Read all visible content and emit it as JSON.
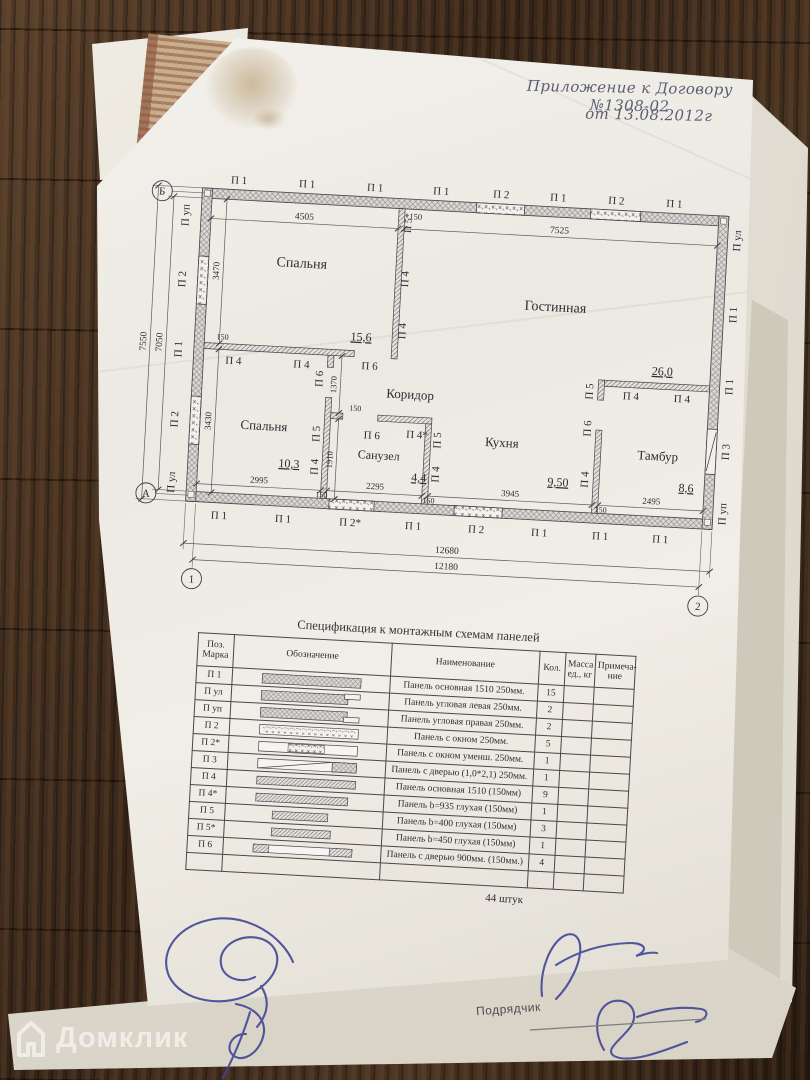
{
  "photo": {
    "handwriting": {
      "line1": "Приложение к Договору №1308-02",
      "line2": "от 13.08.2012г"
    },
    "watermark": {
      "text": "Домклик",
      "icon": "domclick-house-icon"
    },
    "contractor_label": "Подрядчик"
  },
  "colors": {
    "ink_blue": "#3c4396",
    "paper": "#f1eee7",
    "wood": "#432f20",
    "pencil": "#2c2c33"
  },
  "plan": {
    "axes": [
      {
        "label": "Б",
        "x": 22,
        "y": 47
      },
      {
        "label": "А",
        "x": 22,
        "y": 349
      },
      {
        "label": "1",
        "x": 72,
        "y": 432
      },
      {
        "label": "2",
        "x": 578,
        "y": 432
      }
    ],
    "rooms": [
      {
        "name": "Спальня",
        "x": 165,
        "y": 116,
        "fs": 14,
        "area": "15,6",
        "ax": 228,
        "ay": 186
      },
      {
        "name": "Гостинная",
        "x": 420,
        "y": 146,
        "fs": 14,
        "area": "26,0",
        "ax": 530,
        "ay": 204
      },
      {
        "name": "Спальня",
        "x": 136,
        "y": 280,
        "fs": 13,
        "area": "10,3",
        "ax": 163,
        "ay": 316
      },
      {
        "name": "Коридор",
        "x": 280,
        "y": 241,
        "fs": 13
      },
      {
        "name": "Санузел",
        "x": 252,
        "y": 303,
        "fs": 12,
        "area": "4,4",
        "ax": 293,
        "ay": 323
      },
      {
        "name": "Кухня",
        "x": 374,
        "y": 284,
        "fs": 13,
        "area": "9,50",
        "ax": 432,
        "ay": 320
      },
      {
        "name": "Тамбур",
        "x": 530,
        "y": 289,
        "fs": 13,
        "area": "8,6",
        "ax": 560,
        "ay": 319
      }
    ],
    "wall_labels": [
      {
        "t": "П 1",
        "x": 98,
        "y": 36
      },
      {
        "t": "П 1",
        "x": 166,
        "y": 36
      },
      {
        "t": "П 1",
        "x": 234,
        "y": 36
      },
      {
        "t": "П 1",
        "x": 300,
        "y": 36
      },
      {
        "t": "П 2",
        "x": 360,
        "y": 36
      },
      {
        "t": "П 1",
        "x": 417,
        "y": 36
      },
      {
        "t": "П 2",
        "x": 475,
        "y": 36
      },
      {
        "t": "П 1",
        "x": 533,
        "y": 36
      },
      {
        "t": "П уп",
        "x": 50,
        "y": 70,
        "r": -90
      },
      {
        "t": "П 2",
        "x": 50,
        "y": 134,
        "r": -90
      },
      {
        "t": "П 1",
        "x": 50,
        "y": 204,
        "r": -90
      },
      {
        "t": "П 2",
        "x": 50,
        "y": 274,
        "r": -90
      },
      {
        "t": "П ул",
        "x": 50,
        "y": 337,
        "r": -90
      },
      {
        "t": "П ул",
        "x": 601,
        "y": 66,
        "r": -90
      },
      {
        "t": "П 1",
        "x": 601,
        "y": 140,
        "r": -90
      },
      {
        "t": "П 1",
        "x": 601,
        "y": 212,
        "r": -90
      },
      {
        "t": "П 3",
        "x": 601,
        "y": 277,
        "r": -90
      },
      {
        "t": "П уп",
        "x": 601,
        "y": 339,
        "r": -90
      },
      {
        "t": "П 1",
        "x": 96,
        "y": 371
      },
      {
        "t": "П 1",
        "x": 160,
        "y": 371
      },
      {
        "t": "П 2*",
        "x": 227,
        "y": 371
      },
      {
        "t": "П 1",
        "x": 290,
        "y": 371
      },
      {
        "t": "П 2",
        "x": 353,
        "y": 371
      },
      {
        "t": "П 1",
        "x": 416,
        "y": 371
      },
      {
        "t": "П 1",
        "x": 477,
        "y": 371
      },
      {
        "t": "П 1",
        "x": 537,
        "y": 371
      },
      {
        "t": "П 5*",
        "x": 272,
        "y": 66,
        "r": -90,
        "fs": 10
      },
      {
        "t": "П 4",
        "x": 272,
        "y": 122,
        "r": -90
      },
      {
        "t": "П 4",
        "x": 272,
        "y": 174,
        "r": -90
      },
      {
        "t": "П 4",
        "x": 102,
        "y": 216
      },
      {
        "t": "П 4",
        "x": 170,
        "y": 216
      },
      {
        "t": "П 6",
        "x": 238,
        "y": 214
      },
      {
        "t": "П 6",
        "x": 192,
        "y": 226,
        "r": -90
      },
      {
        "t": "П 5",
        "x": 192,
        "y": 281,
        "r": -90
      },
      {
        "t": "П 4",
        "x": 192,
        "y": 314,
        "r": -90
      },
      {
        "t": "П 6",
        "x": 244,
        "y": 283
      },
      {
        "t": "П 4*",
        "x": 289,
        "y": 280
      },
      {
        "t": "П 5",
        "x": 313,
        "y": 281,
        "r": -90
      },
      {
        "t": "П 4",
        "x": 313,
        "y": 315,
        "r": -90
      },
      {
        "t": "П 5",
        "x": 462,
        "y": 224,
        "r": -90
      },
      {
        "t": "П 6",
        "x": 462,
        "y": 261,
        "r": -90
      },
      {
        "t": "П 4",
        "x": 462,
        "y": 312,
        "r": -90
      },
      {
        "t": "П 4",
        "x": 500,
        "y": 230
      },
      {
        "t": "П 4",
        "x": 551,
        "y": 230
      }
    ],
    "dims": [
      {
        "t": "4505",
        "x1": 72,
        "y1": 72,
        "x2": 259,
        "y2": 72,
        "tx": 165,
        "ty": 68
      },
      {
        "t": "150",
        "tx": 276,
        "ty": 62,
        "fs": 8.5
      },
      {
        "t": "7525",
        "x1": 265,
        "y1": 72,
        "x2": 578,
        "y2": 72,
        "tx": 420,
        "ty": 68
      },
      {
        "t": "3470",
        "x1": 87,
        "y1": 52,
        "x2": 87,
        "y2": 196,
        "tx": 83,
        "ty": 124,
        "r": -90,
        "fs": 9
      },
      {
        "t": "3430",
        "x1": 87,
        "y1": 202,
        "x2": 87,
        "y2": 345,
        "tx": 83,
        "ty": 274,
        "r": -90,
        "fs": 9
      },
      {
        "t": "7050",
        "x1": 34,
        "y1": 52,
        "x2": 34,
        "y2": 345,
        "tx": 30,
        "ty": 198,
        "r": -90
      },
      {
        "t": "7550",
        "x1": 18,
        "y1": 42,
        "x2": 18,
        "y2": 355,
        "tx": 14,
        "ty": 198,
        "r": -90
      },
      {
        "t": "1370",
        "x1": 210,
        "y1": 202,
        "x2": 210,
        "y2": 259,
        "tx": 206,
        "ty": 231,
        "r": -90,
        "fs": 8.5
      },
      {
        "t": "1910",
        "x1": 210,
        "y1": 265,
        "x2": 210,
        "y2": 345,
        "tx": 206,
        "ty": 306,
        "r": -90,
        "fs": 8.5
      },
      {
        "t": "2995",
        "x1": 72,
        "y1": 337,
        "x2": 196,
        "y2": 337,
        "tx": 134,
        "ty": 333,
        "fs": 9
      },
      {
        "t": "2295",
        "x1": 202,
        "y1": 337,
        "x2": 297,
        "y2": 337,
        "tx": 250,
        "ty": 333,
        "fs": 9
      },
      {
        "t": "3945",
        "x1": 303,
        "y1": 337,
        "x2": 467,
        "y2": 337,
        "tx": 385,
        "ty": 333,
        "fs": 9
      },
      {
        "t": "2495",
        "x1": 473,
        "y1": 337,
        "x2": 578,
        "y2": 337,
        "tx": 526,
        "ty": 333,
        "fs": 9
      },
      {
        "t": "12680",
        "x1": 62,
        "y1": 397,
        "x2": 588,
        "y2": 397,
        "tx": 325,
        "ty": 393
      },
      {
        "t": "12180",
        "x1": 72,
        "y1": 413,
        "x2": 578,
        "y2": 413,
        "tx": 325,
        "ty": 409
      },
      {
        "t": "150",
        "tx": 90,
        "ty": 192,
        "fs": 8
      },
      {
        "t": "150",
        "tx": 226,
        "ty": 256,
        "fs": 8
      },
      {
        "t": "150",
        "tx": 197,
        "ty": 344,
        "fs": 8
      },
      {
        "t": "150",
        "tx": 304,
        "ty": 344,
        "fs": 8
      },
      {
        "t": "150",
        "tx": 476,
        "ty": 344,
        "fs": 8
      }
    ]
  },
  "spec_table": {
    "title": "Спецификация к монтажным схемам панелей",
    "columns": [
      "Поз.\nМарка",
      "Обозначение",
      "Наименование",
      "Кол.",
      "Масса\nед., кг",
      "Примеча-\nние"
    ],
    "rows": [
      {
        "mark": "П 1",
        "name": "Панель основная 1510 250мм.",
        "qty": "15",
        "symbol": "main250"
      },
      {
        "mark": "П ул",
        "name": "Панель угловая левая 250мм.",
        "qty": "2",
        "symbol": "cornerL"
      },
      {
        "mark": "П уп",
        "name": "Панель угловая правая 250мм.",
        "qty": "2",
        "symbol": "cornerR"
      },
      {
        "mark": "П 2",
        "name": "Панель с окном  250мм.",
        "qty": "5",
        "symbol": "win"
      },
      {
        "mark": "П 2*",
        "name": "Панель с окном  уменш. 250мм.",
        "qty": "1",
        "symbol": "winS"
      },
      {
        "mark": "П 3",
        "name": "Панель с дверью (1,0*2,1)  250мм.",
        "qty": "1",
        "symbol": "door250"
      },
      {
        "mark": "П 4",
        "name": "Панель основная 1510 (150мм)",
        "qty": "9",
        "symbol": "diagL"
      },
      {
        "mark": "П 4*",
        "name": "Панель b=935 глухая (150мм)",
        "qty": "1",
        "symbol": "diagL2"
      },
      {
        "mark": "П 5",
        "name": "Панель b=400 глухая (150мм)",
        "qty": "3",
        "symbol": "diagS"
      },
      {
        "mark": "П 5*",
        "name": "Панель b=450 глухая (150мм)",
        "qty": "1",
        "symbol": "diagS2"
      },
      {
        "mark": "П 6",
        "name": "Панель с дверью 900мм.  (150мм.)",
        "qty": "4",
        "symbol": "door150"
      },
      {
        "mark": "",
        "name": "",
        "qty": "",
        "symbol": ""
      }
    ],
    "total": "44 штук"
  }
}
